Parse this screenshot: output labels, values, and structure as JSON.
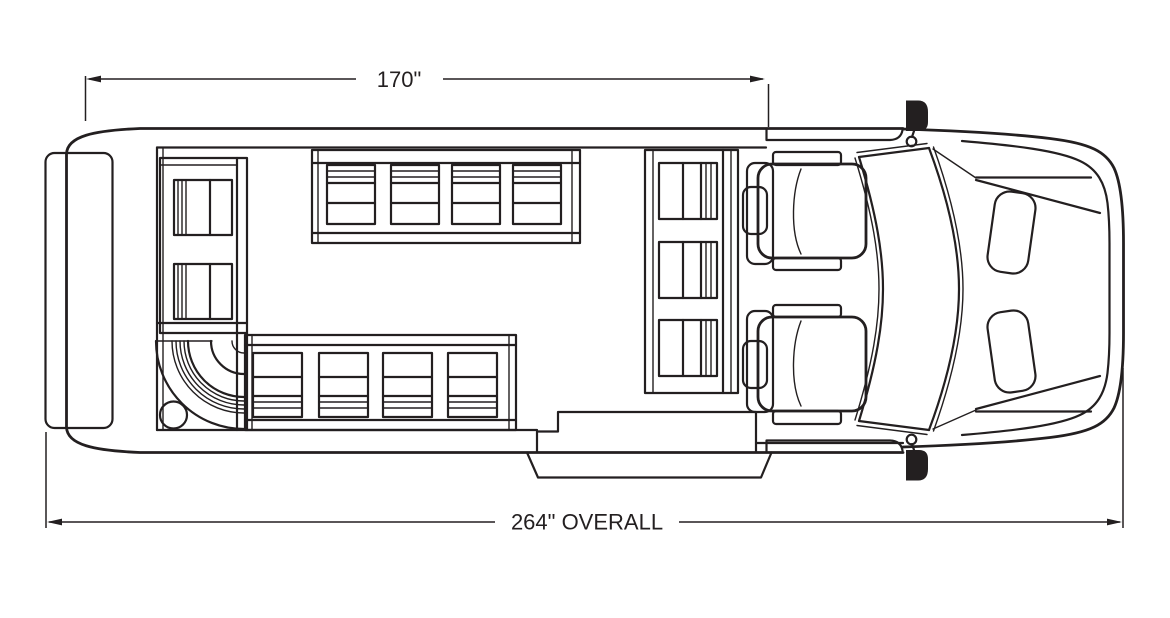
{
  "diagram": {
    "type": "vehicle-floorplan-top-view",
    "dimensions": {
      "body_length": {
        "label": "170\""
      },
      "overall_length": {
        "label": "264\" OVERALL"
      }
    },
    "colors": {
      "line": "#231f20",
      "background": "#ffffff"
    },
    "features": {
      "benches": [
        {
          "name": "rear-bench",
          "seats": 2
        },
        {
          "name": "corner-bench",
          "seats": 1
        },
        {
          "name": "street-side-bench",
          "seats": 4
        },
        {
          "name": "curb-side-bench",
          "seats": 4
        },
        {
          "name": "forward-bench",
          "seats": 3
        }
      ],
      "cab_seats": [
        "driver-seat",
        "passenger-seat"
      ],
      "mirrors": 2,
      "entry": "curb-side entry step"
    }
  }
}
